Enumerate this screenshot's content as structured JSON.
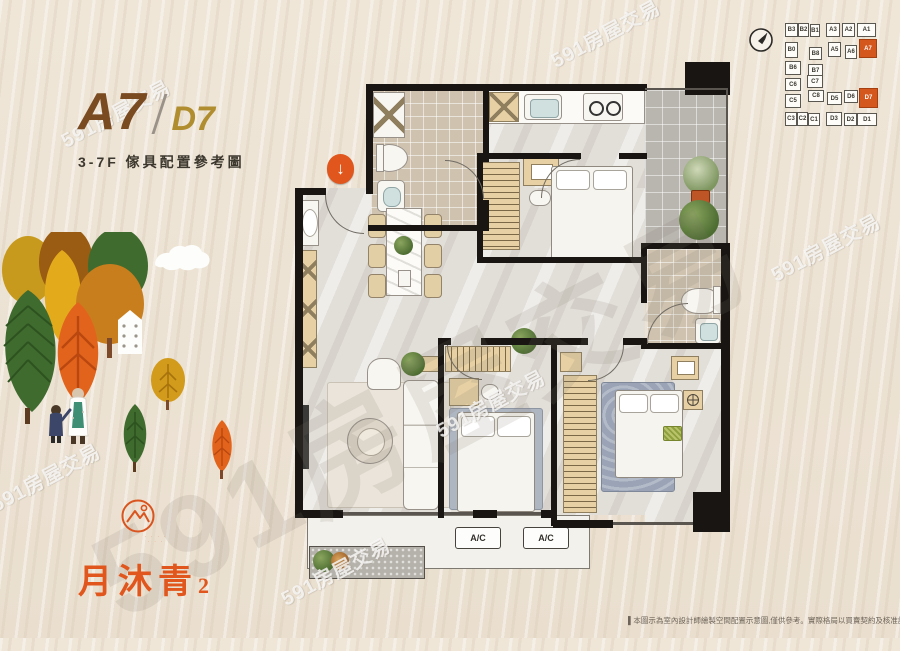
{
  "title": {
    "main": "A7",
    "secondary": "D7",
    "subtitle": "3-7F 傢具配置參考圖"
  },
  "keyplan": {
    "cells": [
      {
        "label": "B3"
      },
      {
        "label": "B2"
      },
      {
        "label": "B1"
      },
      {
        "label": "A3"
      },
      {
        "label": "A2"
      },
      {
        "label": "A1"
      },
      {
        "label": "B0"
      },
      {
        "label": "B8"
      },
      {
        "label": "A5"
      },
      {
        "label": "A6"
      },
      {
        "label": "A7",
        "highlighted": true
      },
      {
        "label": "B6"
      },
      {
        "label": "B7"
      },
      {
        "label": "C6"
      },
      {
        "label": "C7"
      },
      {
        "label": "C5"
      },
      {
        "label": "C8"
      },
      {
        "label": "D5"
      },
      {
        "label": "D6"
      },
      {
        "label": "D7",
        "highlighted": true
      },
      {
        "label": "C3"
      },
      {
        "label": "C2"
      },
      {
        "label": "C1"
      },
      {
        "label": "D3"
      },
      {
        "label": "D2"
      },
      {
        "label": "D1"
      }
    ]
  },
  "plan": {
    "ac_label_1": "A/C",
    "ac_label_2": "A/C"
  },
  "logo": {
    "name": "月沐青",
    "number": "2"
  },
  "watermark": {
    "text": "591房屋交易"
  },
  "disclaimer": "▌本圖示為室內設計師繪製空間配置示意圖,僅供參考。實際格局以買賣契約及核准設計圖說為準",
  "colors": {
    "accent_orange": "#e0561c",
    "title_main_brown": "#7a4a21",
    "title_secondary_gold": "#b08d2e",
    "wall_black": "#181512",
    "highlight_unit": "#d4571d"
  }
}
